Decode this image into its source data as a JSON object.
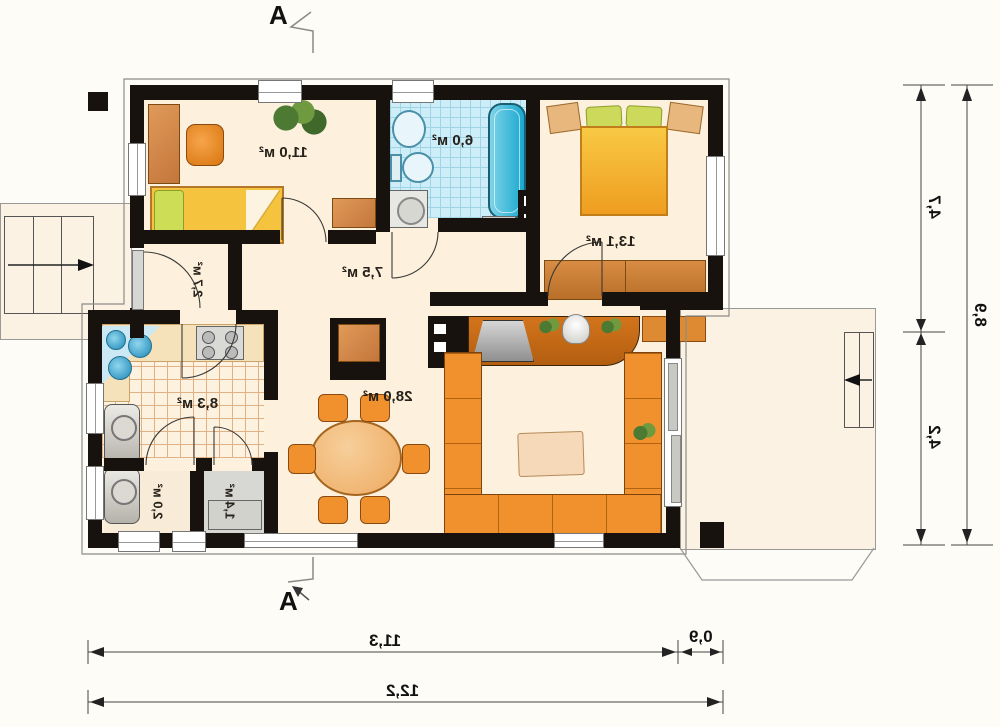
{
  "plan": {
    "section_marker": "A",
    "rooms": {
      "room1": "11,0 м²",
      "bathroom": "6,0 м²",
      "bedroom": "13,1 м²",
      "corridor": "7,5 м²",
      "hall": "2,7 м²",
      "kitchen": "8,3 м²",
      "pantry": "2,0 м²",
      "closet": "1,4 м²",
      "living_room": "28,0 м²"
    },
    "dimensions": {
      "right_upper": "4,7",
      "right_lower": "4,2",
      "right_total": "8,9",
      "bottom_main": "11,3",
      "bottom_ext": "0,9",
      "bottom_total": "12,2"
    },
    "colors": {
      "wall": "#17120d",
      "floor": "#fdf0dc",
      "bath_tile": "#cdeef8",
      "kitchen_tile": "#fdf2df",
      "furniture_orange": "#f0912e",
      "wood_brown": "#cd7f3e",
      "water_blue": "#2fb3da",
      "outdoor": "#fbf2e3"
    }
  }
}
